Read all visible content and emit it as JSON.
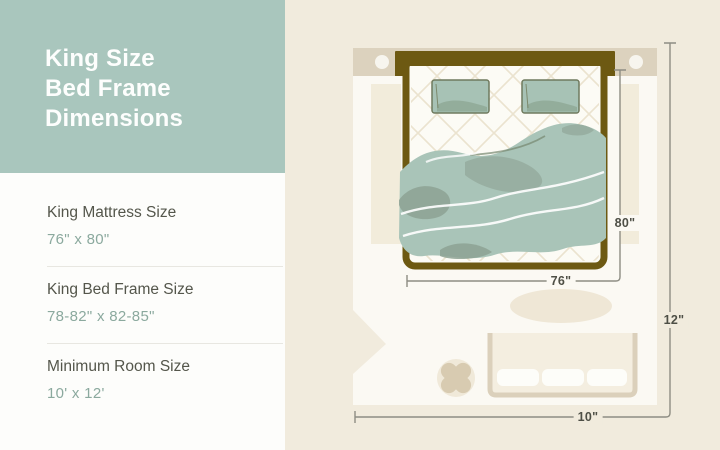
{
  "title": {
    "lines": [
      "King Size",
      "Bed Frame",
      "Dimensions"
    ]
  },
  "specs": {
    "items": [
      {
        "label": "King Mattress Size",
        "value": "76\" x 80\""
      },
      {
        "label": "King Bed Frame Size",
        "value": "78-82\" x 82-85\""
      },
      {
        "label": "Minimum Room Size",
        "value": "10' x 12'"
      }
    ]
  },
  "diagram": {
    "dimension_labels": {
      "bed_length": "80\"",
      "bed_width": "76\"",
      "room_length": "12\"",
      "room_width": "10\""
    },
    "icons": [
      "bed-icon",
      "pillow-icon",
      "blanket-icon",
      "rug-icon",
      "dresser-icon",
      "plant-icon",
      "door-icon",
      "sconce-icon"
    ]
  },
  "colors": {
    "accent_teal": "#a9c6bd",
    "panel_white": "#fdfdfb",
    "page_cream": "#f1ebdd",
    "wall_beige": "#dcd2be",
    "floor_white": "#fbf9f3",
    "bed_frame_olive": "#6d5912",
    "blanket_teal": "#a9c4b8",
    "blanket_shade": "#8da293",
    "pillow_teal": "#a7c2b5",
    "furniture_beige": "#dbd0bb",
    "dimension_gray": "#8e8d83",
    "heading_text": "#54564b",
    "value_text": "#8ba99e",
    "label_text": "#4e4f46"
  }
}
